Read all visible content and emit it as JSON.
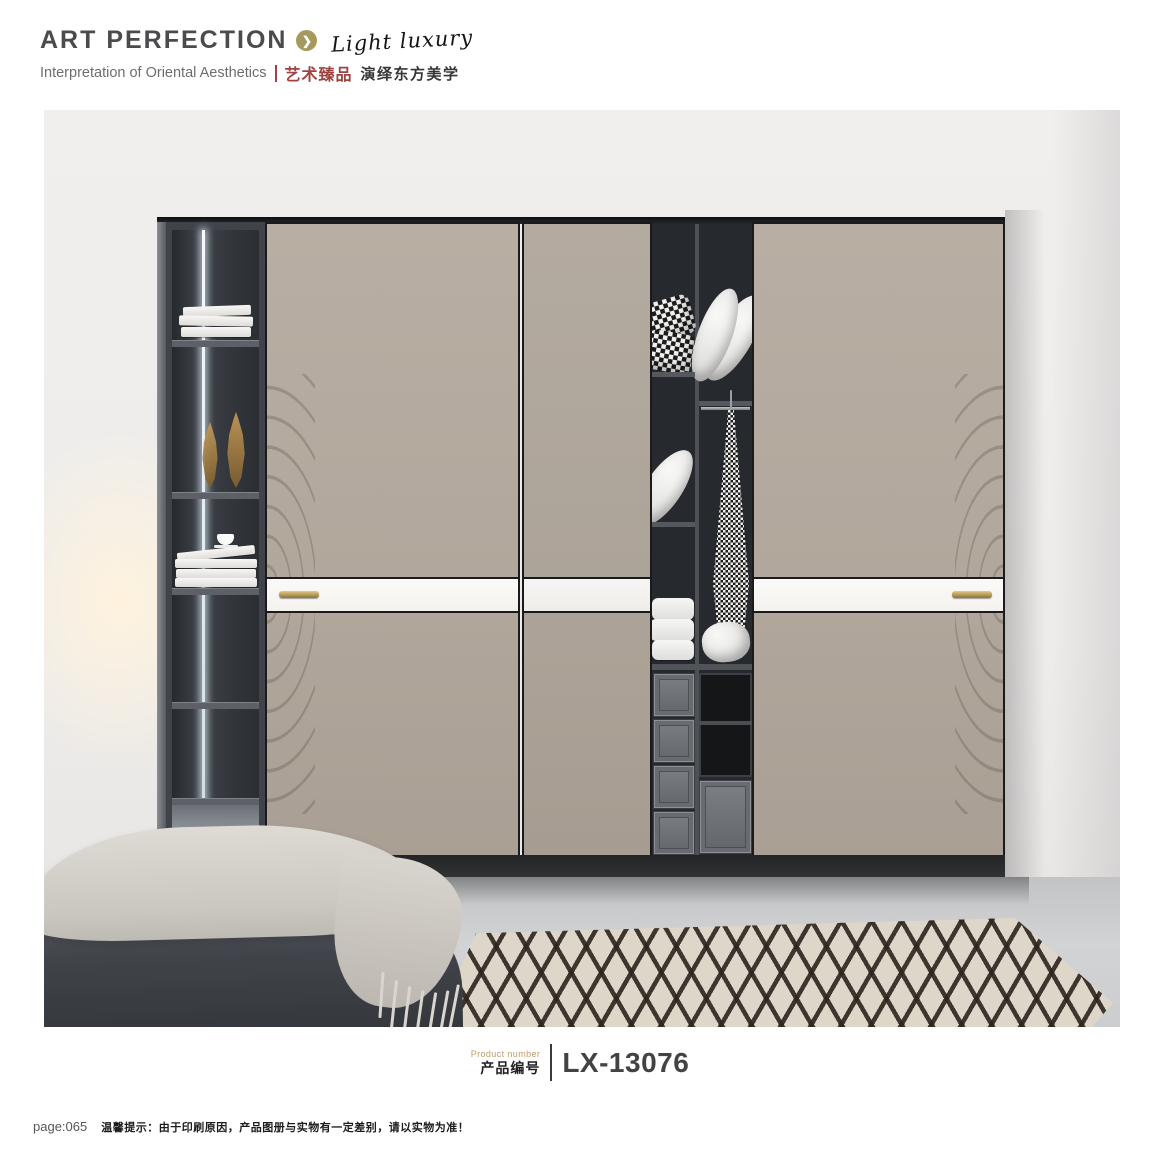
{
  "brand": {
    "name": "ART PERFECTION",
    "arrow_glyph": "❯",
    "script": "Light luxury",
    "tagline_en": "Interpretation of Oriental Aesthetics",
    "series_cn": "艺术臻品",
    "tagline_cn": "演绎东方美学"
  },
  "product": {
    "label_en": "Product number",
    "label_cn": "产品编号",
    "code": "LX-13076"
  },
  "footer": {
    "page": "page:065",
    "notice": "温馨提示：由于印刷原因，产品图册与实物有一定差别，请以实物为准！"
  },
  "colors": {
    "accent_gold": "#a5995e",
    "brand_red": "#9e4242",
    "door_taupe": "#b1a79c",
    "handle_gold": "#b69a55",
    "cabinet_dark": "#40444a",
    "strip_white": "#f8f6f2"
  }
}
